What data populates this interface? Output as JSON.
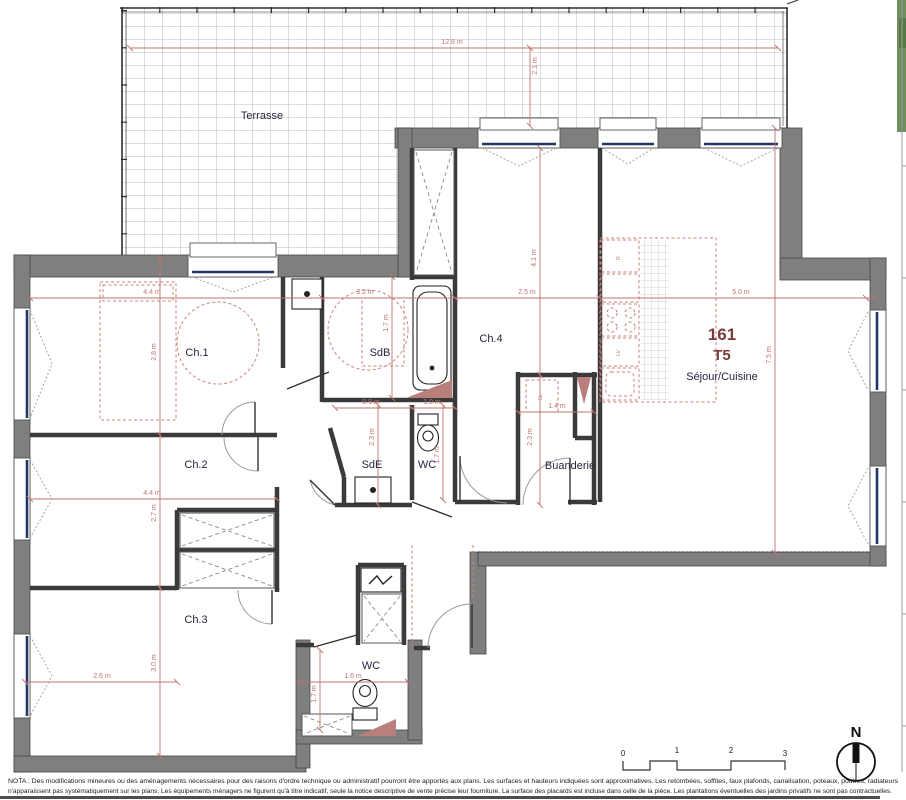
{
  "unit": {
    "number": "161",
    "type": "T5",
    "room": "Séjour/Cuisine"
  },
  "rooms": {
    "terrasse": "Terrasse",
    "ch1": "Ch.1",
    "sdb": "SdB",
    "ch4": "Ch.4",
    "ch2": "Ch.2",
    "sde": "SdE",
    "wc_top": "WC",
    "buanderie": "Buanderie",
    "ch3": "Ch.3",
    "wc_bottom": "WC"
  },
  "dims": {
    "terrace_width": "12.8 m",
    "terrace_depth": "2.1 m",
    "ch1_width": "4.4 m",
    "ch1_depth": "2.8 m",
    "sdb_width": "3.2 m",
    "sdb_depth": "1.7 m",
    "ch4_width": "2.5 m",
    "ch4_depth": "4.1 m",
    "sejour_width": "5.0 m",
    "sejour_depth": "7.5 m",
    "sde_width": "0.9 m",
    "sde_depth": "2.3 m",
    "wc_top_width": "1.0 m",
    "wc_top_depth": "1.7 m",
    "buanderie_width": "1.4 m",
    "buanderie_depth": "2.3 m",
    "ch2_width": "4.4 m",
    "ch2_depth": "2.7 m",
    "ch3_width": "2.6 m",
    "ch3_depth": "3.0 m",
    "wc_bottom_width": "1.6 m",
    "wc_bottom_depth": "1.7 m"
  },
  "appliances": {
    "fridge": "R",
    "dishwasher": "LV",
    "washing_machine": "LL"
  },
  "scale_bar": {
    "tick0": "0",
    "tick1": "1",
    "tick2": "2",
    "tick3": "3"
  },
  "compass": {
    "label": "N"
  },
  "nota": {
    "line1": "NOTA : Des modifications mineures ou des aménagements nécessaires pour des raisons d'ordre technique ou administratif pourront être apportés aux plans. Les surfaces et hauteurs indiquées sont approximatives. Les retombées, soffites, faux plafonds, canalisation, poteaux, poutres, radiateurs",
    "line2": "n'apparaissent pas systématiquement sur les plans.  Les équipements ménagers ne figurent qu'à titre indicatif, seule la notice descriptive de vente précise leur fourniture. La surface des placards est incluse dans celle de la pièce. Les plantations éventuelles des jardins privatifs ne sont pas contractuelles."
  },
  "colors": {
    "dimension": "#c0736d",
    "wall": "#7f7f7f",
    "room_label": "#26263e",
    "unit_label": "#7b3b3b",
    "glazing": "#1e3767",
    "triangle": "#b97f7c"
  }
}
